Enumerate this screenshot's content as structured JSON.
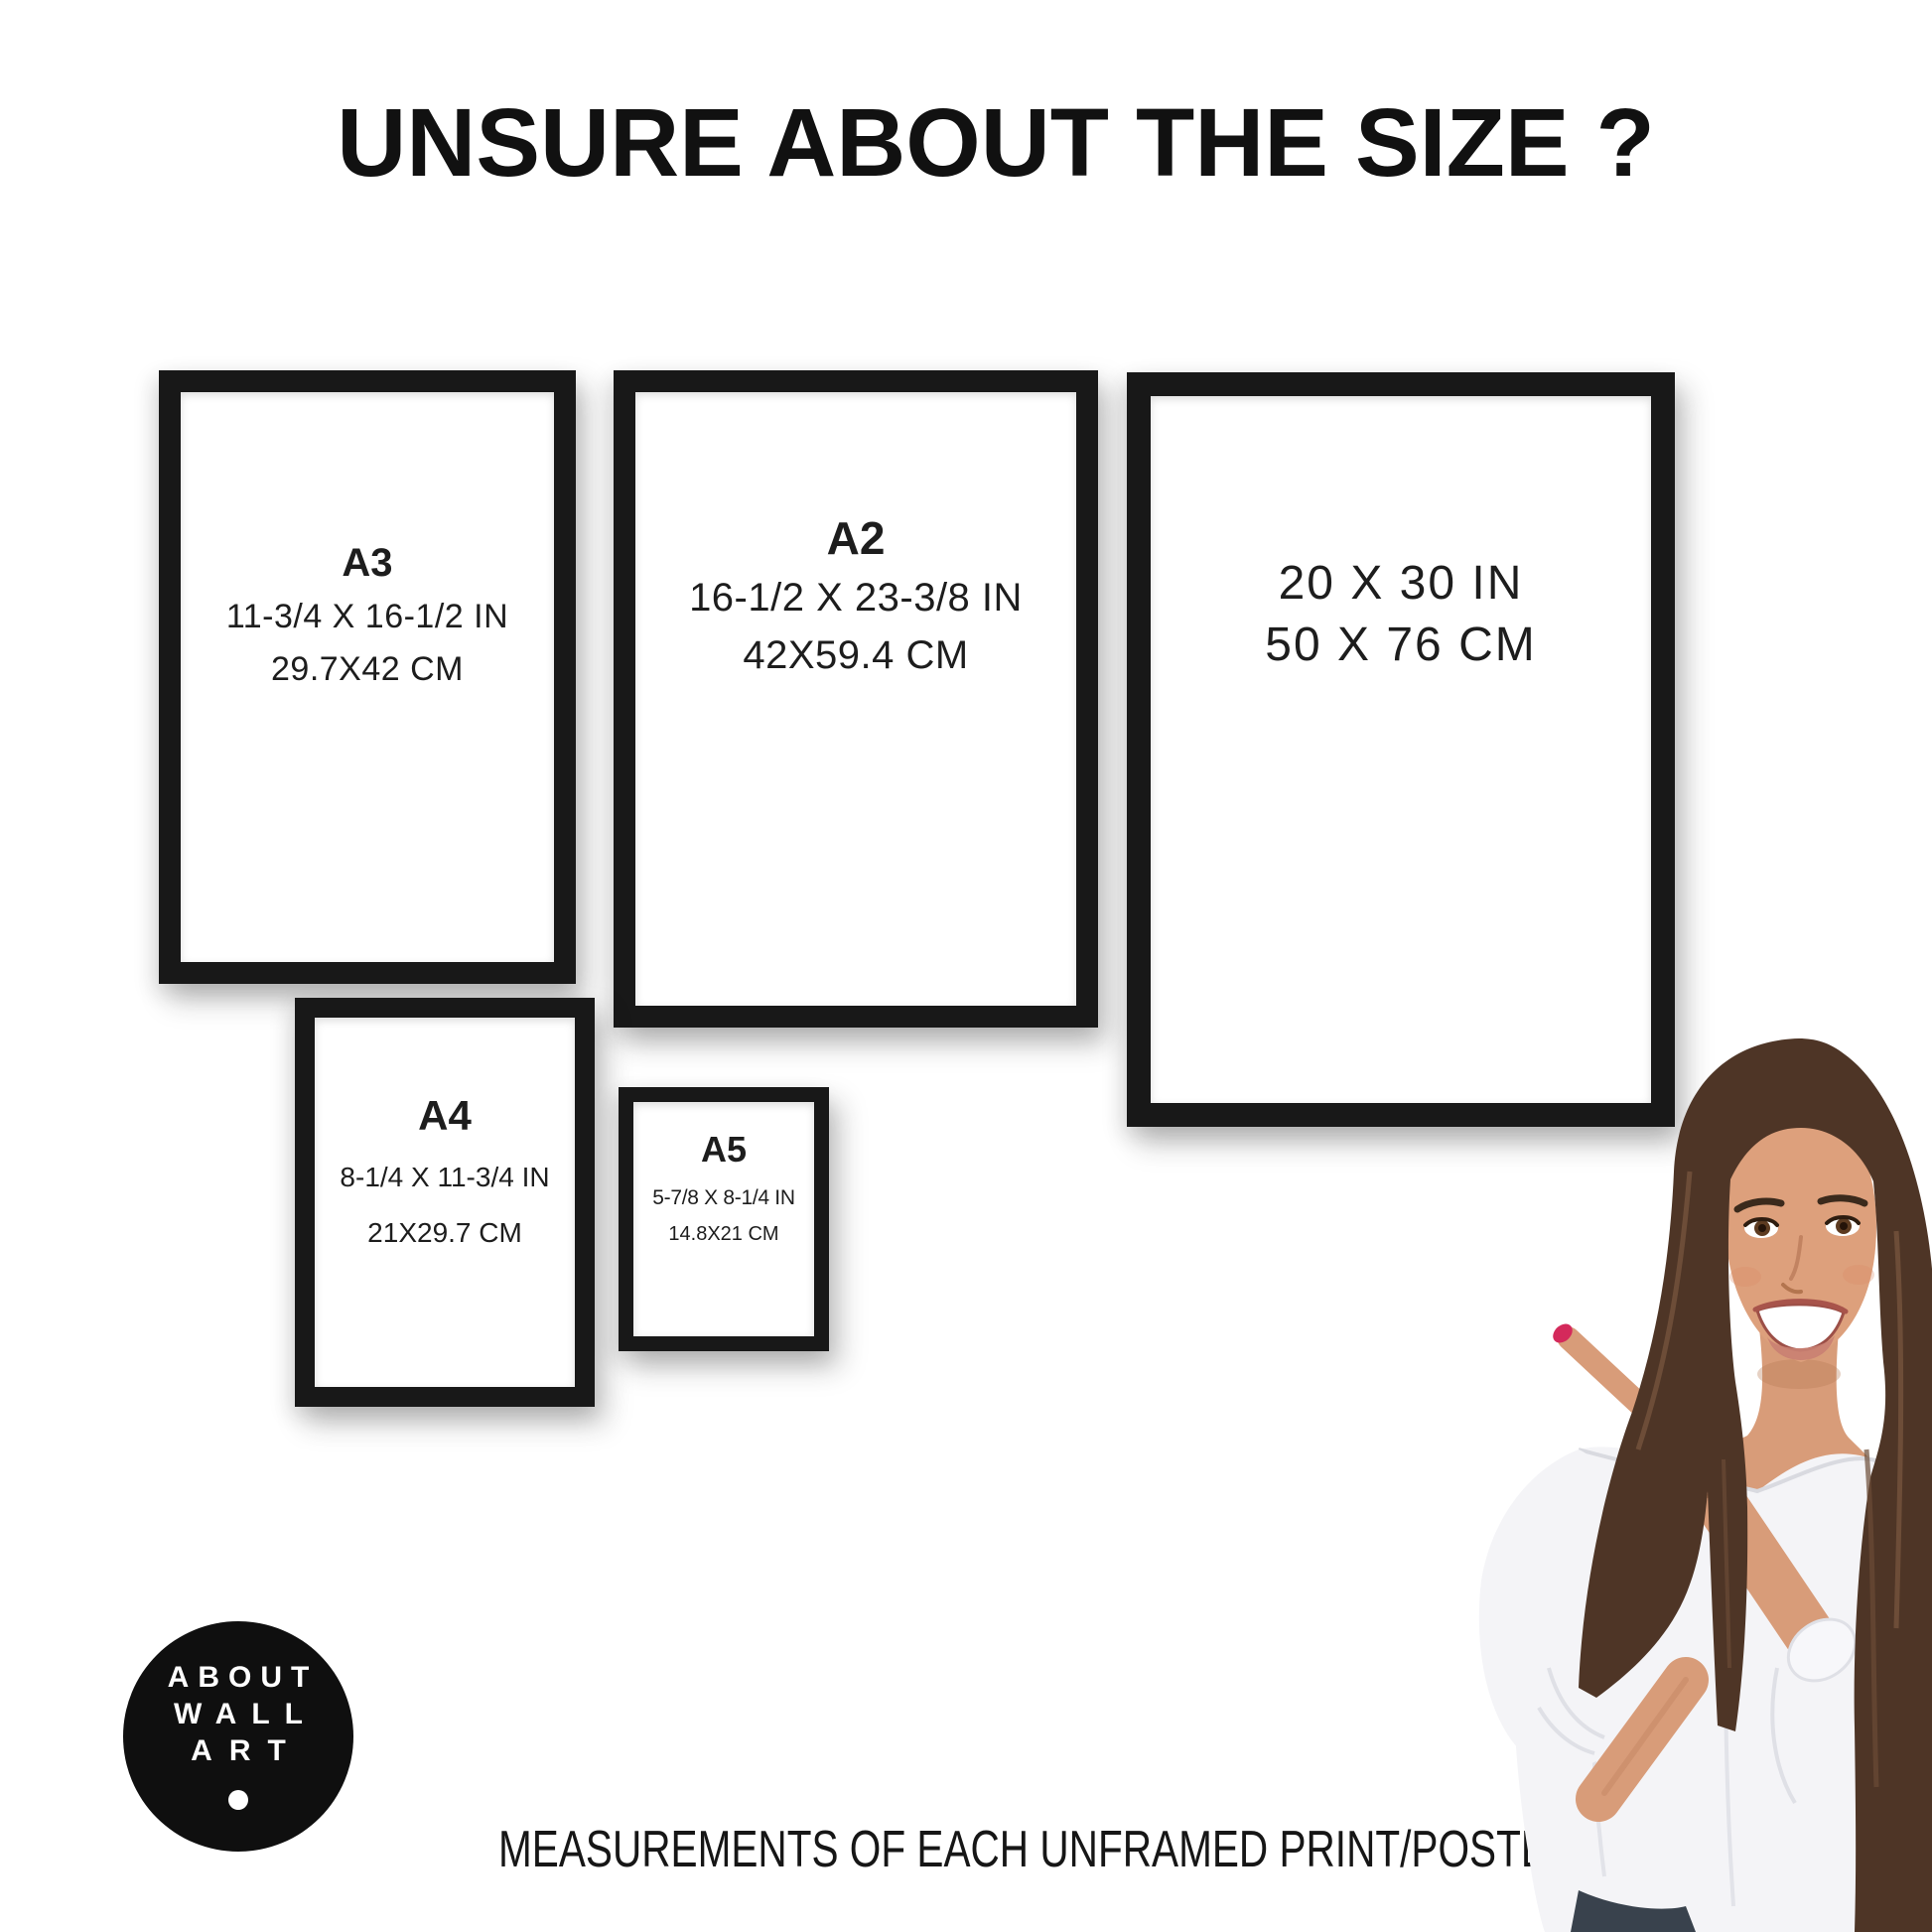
{
  "header": {
    "title": "UNSURE ABOUT THE SIZE ?"
  },
  "frames": [
    {
      "key": "a3",
      "label": "A3",
      "size_in": "11-3/4 X 16-1/2 IN",
      "size_cm": "29.7X42 CM"
    },
    {
      "key": "a2",
      "label": "A2",
      "size_in": "16-1/2 X 23-3/8 IN",
      "size_cm": "42X59.4 CM"
    },
    {
      "key": "20x30",
      "label": "",
      "size_in": "20 X 30 IN",
      "size_cm": "50 X 76 CM"
    },
    {
      "key": "a4",
      "label": "A4",
      "size_in": "8-1/4 X 11-3/4 IN",
      "size_cm": "21X29.7 CM"
    },
    {
      "key": "a5",
      "label": "A5",
      "size_in": "5-7/8 X 8-1/4 IN",
      "size_cm": "14.8X21 CM"
    }
  ],
  "logo": {
    "line1": "ABOUT",
    "line2": "WALL",
    "line3": "ART"
  },
  "footer": {
    "caption": "MEASUREMENTS OF EACH UNFRAMED PRINT/POSTER"
  },
  "colors": {
    "background": "#ffffff",
    "frame": "#181818",
    "text": "#1c1c1c",
    "logo_background": "#0f0f0f",
    "logo_text": "#ffffff",
    "hair": "#4e3526",
    "skin": "#d89c79",
    "blouse": "#f4f4f7",
    "nail_polish": "#d4295b",
    "bracelet": "#d7a54a",
    "jeans": "#39424d"
  }
}
